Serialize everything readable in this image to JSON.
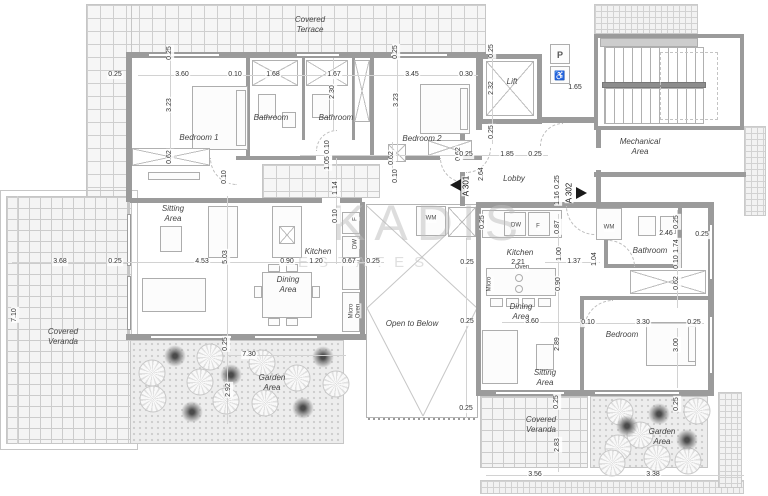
{
  "watermark": {
    "line1": "KADIS",
    "line2": "ESTATES"
  },
  "colors": {
    "wall": "#9b9b9b",
    "dim_text": "#333333",
    "room_text": "#444444",
    "watermark": "#c0c0c0",
    "marker": "#1a1a1a"
  },
  "markers": [
    {
      "label": "A 301"
    },
    {
      "label": "A 302"
    }
  ],
  "room_labels": [
    {
      "text": "Covered\nTerrace",
      "x": 310,
      "y": 25
    },
    {
      "text": "Bedroom 1",
      "x": 199,
      "y": 138
    },
    {
      "text": "Bathroom",
      "x": 271,
      "y": 118
    },
    {
      "text": "Bathroom",
      "x": 336,
      "y": 118
    },
    {
      "text": "Bedroom 2",
      "x": 422,
      "y": 139
    },
    {
      "text": "Lift",
      "x": 512,
      "y": 82
    },
    {
      "text": "Lobby",
      "x": 514,
      "y": 179
    },
    {
      "text": "Mechanical\nArea",
      "x": 640,
      "y": 147
    },
    {
      "text": "Sitting\nArea",
      "x": 173,
      "y": 214
    },
    {
      "text": "Kitchen",
      "x": 318,
      "y": 252
    },
    {
      "text": "Dining\nArea",
      "x": 288,
      "y": 285
    },
    {
      "text": "Covered\nVeranda",
      "x": 63,
      "y": 337
    },
    {
      "text": "Garden\nArea",
      "x": 272,
      "y": 383
    },
    {
      "text": "Open to Below",
      "x": 412,
      "y": 324
    },
    {
      "text": "Kitchen",
      "x": 520,
      "y": 253
    },
    {
      "text": "Dining\nArea",
      "x": 521,
      "y": 312
    },
    {
      "text": "Sitting\nArea",
      "x": 545,
      "y": 378
    },
    {
      "text": "Bathroom",
      "x": 650,
      "y": 251
    },
    {
      "text": "Bedroom",
      "x": 622,
      "y": 335
    },
    {
      "text": "Covered\nVeranda",
      "x": 541,
      "y": 425
    },
    {
      "text": "Garden\nArea",
      "x": 662,
      "y": 437
    }
  ],
  "dim_labels": [
    {
      "text": "0.25",
      "x": 115,
      "y": 75
    },
    {
      "text": "3.60",
      "x": 182,
      "y": 75
    },
    {
      "text": "0.10",
      "x": 235,
      "y": 75
    },
    {
      "text": "1.68",
      "x": 273,
      "y": 75
    },
    {
      "text": "1.67",
      "x": 334,
      "y": 75
    },
    {
      "text": "3.45",
      "x": 412,
      "y": 75
    },
    {
      "text": "0.30",
      "x": 466,
      "y": 75
    },
    {
      "text": "0.25",
      "x": 170,
      "y": 53,
      "v": 1
    },
    {
      "text": "3.23",
      "x": 170,
      "y": 105,
      "v": 1
    },
    {
      "text": "0.62",
      "x": 170,
      "y": 157,
      "v": 1
    },
    {
      "text": "2.30",
      "x": 333,
      "y": 92,
      "v": 1
    },
    {
      "text": "0.25",
      "x": 396,
      "y": 52,
      "v": 1
    },
    {
      "text": "3.23",
      "x": 397,
      "y": 100,
      "v": 1
    },
    {
      "text": "0.25",
      "x": 492,
      "y": 51,
      "v": 1
    },
    {
      "text": "2.32",
      "x": 492,
      "y": 88,
      "v": 1
    },
    {
      "text": "0.25",
      "x": 492,
      "y": 132,
      "v": 1
    },
    {
      "text": "1.65",
      "x": 575,
      "y": 88
    },
    {
      "text": "0.62",
      "x": 459,
      "y": 154,
      "v": 1
    },
    {
      "text": "0.25",
      "x": 466,
      "y": 155
    },
    {
      "text": "1.85",
      "x": 507,
      "y": 155
    },
    {
      "text": "0.25",
      "x": 535,
      "y": 155
    },
    {
      "text": "0.10",
      "x": 328,
      "y": 147,
      "v": 1
    },
    {
      "text": "1.05",
      "x": 328,
      "y": 163,
      "v": 1
    },
    {
      "text": "0.62",
      "x": 392,
      "y": 158,
      "v": 1
    },
    {
      "text": "1.14",
      "x": 336,
      "y": 188,
      "v": 1
    },
    {
      "text": "0.10",
      "x": 336,
      "y": 216,
      "v": 1
    },
    {
      "text": "0.10",
      "x": 396,
      "y": 176,
      "v": 1
    },
    {
      "text": "2.64",
      "x": 482,
      "y": 174,
      "v": 1
    },
    {
      "text": "0.25",
      "x": 558,
      "y": 182,
      "v": 1
    },
    {
      "text": "1.16",
      "x": 558,
      "y": 198,
      "v": 1
    },
    {
      "text": "3.68",
      "x": 60,
      "y": 262
    },
    {
      "text": "0.25",
      "x": 115,
      "y": 262
    },
    {
      "text": "4.53",
      "x": 202,
      "y": 262
    },
    {
      "text": "5.03",
      "x": 226,
      "y": 257,
      "v": 1
    },
    {
      "text": "0.90",
      "x": 287,
      "y": 262
    },
    {
      "text": "1.20",
      "x": 316,
      "y": 262
    },
    {
      "text": "0.67",
      "x": 349,
      "y": 262
    },
    {
      "text": "0.25",
      "x": 373,
      "y": 262
    },
    {
      "text": "7.10",
      "x": 15,
      "y": 315,
      "v": 1
    },
    {
      "text": "0.10",
      "x": 225,
      "y": 177,
      "v": 1
    },
    {
      "text": "0.25",
      "x": 467,
      "y": 263
    },
    {
      "text": "0.25",
      "x": 467,
      "y": 322
    },
    {
      "text": "0.25",
      "x": 466,
      "y": 409
    },
    {
      "text": "0.25",
      "x": 483,
      "y": 222,
      "v": 1
    },
    {
      "text": "0.87",
      "x": 558,
      "y": 227,
      "v": 1
    },
    {
      "text": "1.00",
      "x": 560,
      "y": 254,
      "v": 1
    },
    {
      "text": "0.90",
      "x": 559,
      "y": 284,
      "v": 1
    },
    {
      "text": "1.37",
      "x": 574,
      "y": 262
    },
    {
      "text": "1.04",
      "x": 595,
      "y": 259,
      "v": 1
    },
    {
      "text": "2.21",
      "x": 518,
      "y": 263
    },
    {
      "text": "3.60",
      "x": 532,
      "y": 322
    },
    {
      "text": "0.10",
      "x": 588,
      "y": 323
    },
    {
      "text": "3.30",
      "x": 643,
      "y": 323
    },
    {
      "text": "0.25",
      "x": 694,
      "y": 323
    },
    {
      "text": "3.00",
      "x": 677,
      "y": 345,
      "v": 1
    },
    {
      "text": "2.89",
      "x": 558,
      "y": 344,
      "v": 1
    },
    {
      "text": "2.46",
      "x": 666,
      "y": 234
    },
    {
      "text": "0.25",
      "x": 702,
      "y": 235
    },
    {
      "text": "0.25",
      "x": 677,
      "y": 222,
      "v": 1
    },
    {
      "text": "1.74",
      "x": 677,
      "y": 246,
      "v": 1
    },
    {
      "text": "0.10",
      "x": 677,
      "y": 262,
      "v": 1
    },
    {
      "text": "0.62",
      "x": 677,
      "y": 283,
      "v": 1
    },
    {
      "text": "0.25",
      "x": 226,
      "y": 344,
      "v": 1
    },
    {
      "text": "7.30",
      "x": 249,
      "y": 355
    },
    {
      "text": "2.92",
      "x": 229,
      "y": 390,
      "v": 1
    },
    {
      "text": "0.25",
      "x": 557,
      "y": 402,
      "v": 1
    },
    {
      "text": "2.83",
      "x": 558,
      "y": 445,
      "v": 1
    },
    {
      "text": "3.56",
      "x": 535,
      "y": 475
    },
    {
      "text": "3.38",
      "x": 653,
      "y": 475
    },
    {
      "text": "0.25",
      "x": 677,
      "y": 404,
      "v": 1
    }
  ],
  "appliance_labels": [
    {
      "text": "WM",
      "x": 431,
      "y": 219
    },
    {
      "text": "F",
      "x": 356,
      "y": 219,
      "v": 1
    },
    {
      "text": "DW",
      "x": 356,
      "y": 244,
      "v": 1
    },
    {
      "text": "Micro\nOven",
      "x": 355,
      "y": 311,
      "v": 1
    },
    {
      "text": "DW",
      "x": 516,
      "y": 226
    },
    {
      "text": "F",
      "x": 538,
      "y": 227
    },
    {
      "text": "Oven",
      "x": 522,
      "y": 268
    },
    {
      "text": "Micro",
      "x": 490,
      "y": 284,
      "v": 1
    },
    {
      "text": "WM",
      "x": 609,
      "y": 228
    },
    {
      "text": "P",
      "x": 560,
      "y": 55,
      "cls": "sign"
    },
    {
      "text": "♿",
      "x": 560,
      "y": 76,
      "cls": "sign"
    }
  ],
  "trees": [
    {
      "x": 152,
      "y": 373,
      "cls": "tree-bush"
    },
    {
      "x": 210,
      "y": 357,
      "cls": "tree-bush"
    },
    {
      "x": 200,
      "y": 382,
      "cls": "tree-bush"
    },
    {
      "x": 153,
      "y": 399,
      "cls": "tree-bush"
    },
    {
      "x": 226,
      "y": 401,
      "cls": "tree-bush"
    },
    {
      "x": 262,
      "y": 363,
      "cls": "tree-bush"
    },
    {
      "x": 297,
      "y": 378,
      "cls": "tree-bush"
    },
    {
      "x": 265,
      "y": 403,
      "cls": "tree-bush"
    },
    {
      "x": 336,
      "y": 384,
      "cls": "tree-bush"
    },
    {
      "x": 175,
      "y": 356,
      "cls": "tree-dark"
    },
    {
      "x": 231,
      "y": 375,
      "cls": "tree-dark"
    },
    {
      "x": 192,
      "y": 412,
      "cls": "tree-dark"
    },
    {
      "x": 323,
      "y": 357,
      "cls": "tree-dark"
    },
    {
      "x": 303,
      "y": 408,
      "cls": "tree-dark"
    },
    {
      "x": 620,
      "y": 412,
      "cls": "tree-bush"
    },
    {
      "x": 640,
      "y": 435,
      "cls": "tree-bush"
    },
    {
      "x": 618,
      "y": 448,
      "cls": "tree-bush"
    },
    {
      "x": 657,
      "y": 458,
      "cls": "tree-bush"
    },
    {
      "x": 697,
      "y": 411,
      "cls": "tree-bush"
    },
    {
      "x": 688,
      "y": 461,
      "cls": "tree-bush"
    },
    {
      "x": 612,
      "y": 463,
      "cls": "tree-bush"
    },
    {
      "x": 659,
      "y": 414,
      "cls": "tree-dark"
    },
    {
      "x": 687,
      "y": 440,
      "cls": "tree-dark"
    },
    {
      "x": 627,
      "y": 426,
      "cls": "tree-dark"
    }
  ]
}
